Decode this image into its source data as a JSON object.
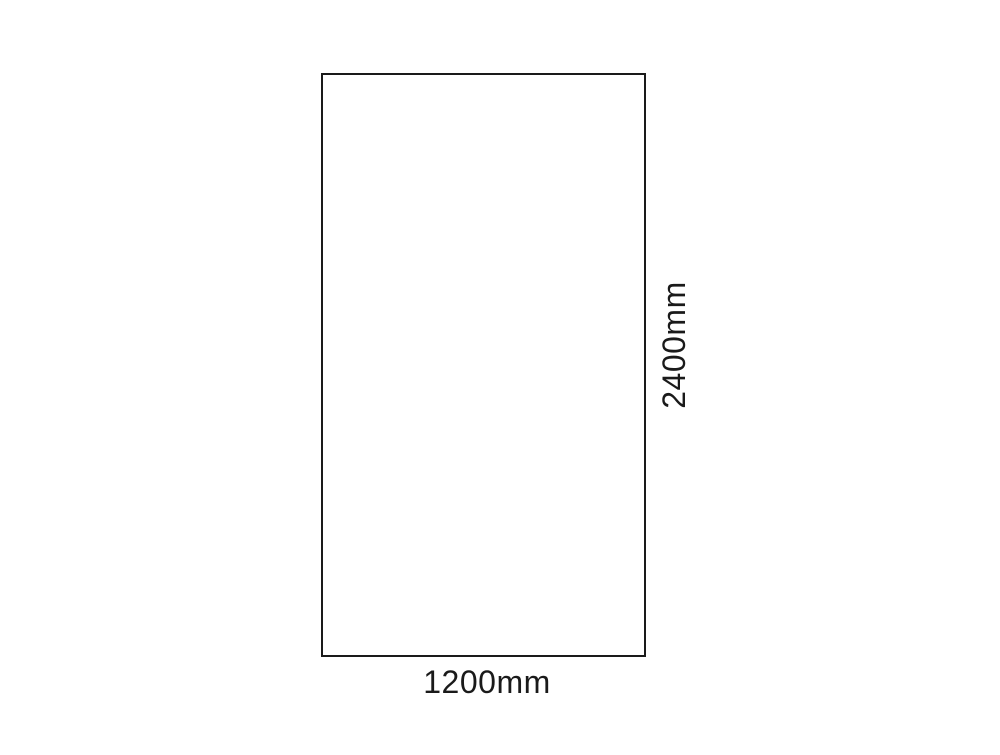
{
  "page": {
    "background_color": "#ffffff"
  },
  "diagram": {
    "kind": "rectangle-dimension-diagram",
    "rectangle": {
      "border_color": "#1a1a1a",
      "fill_color": "#ffffff"
    },
    "labels": {
      "height": "2400mm",
      "width": "1200mm"
    },
    "text_color": "#1a1a1a"
  }
}
